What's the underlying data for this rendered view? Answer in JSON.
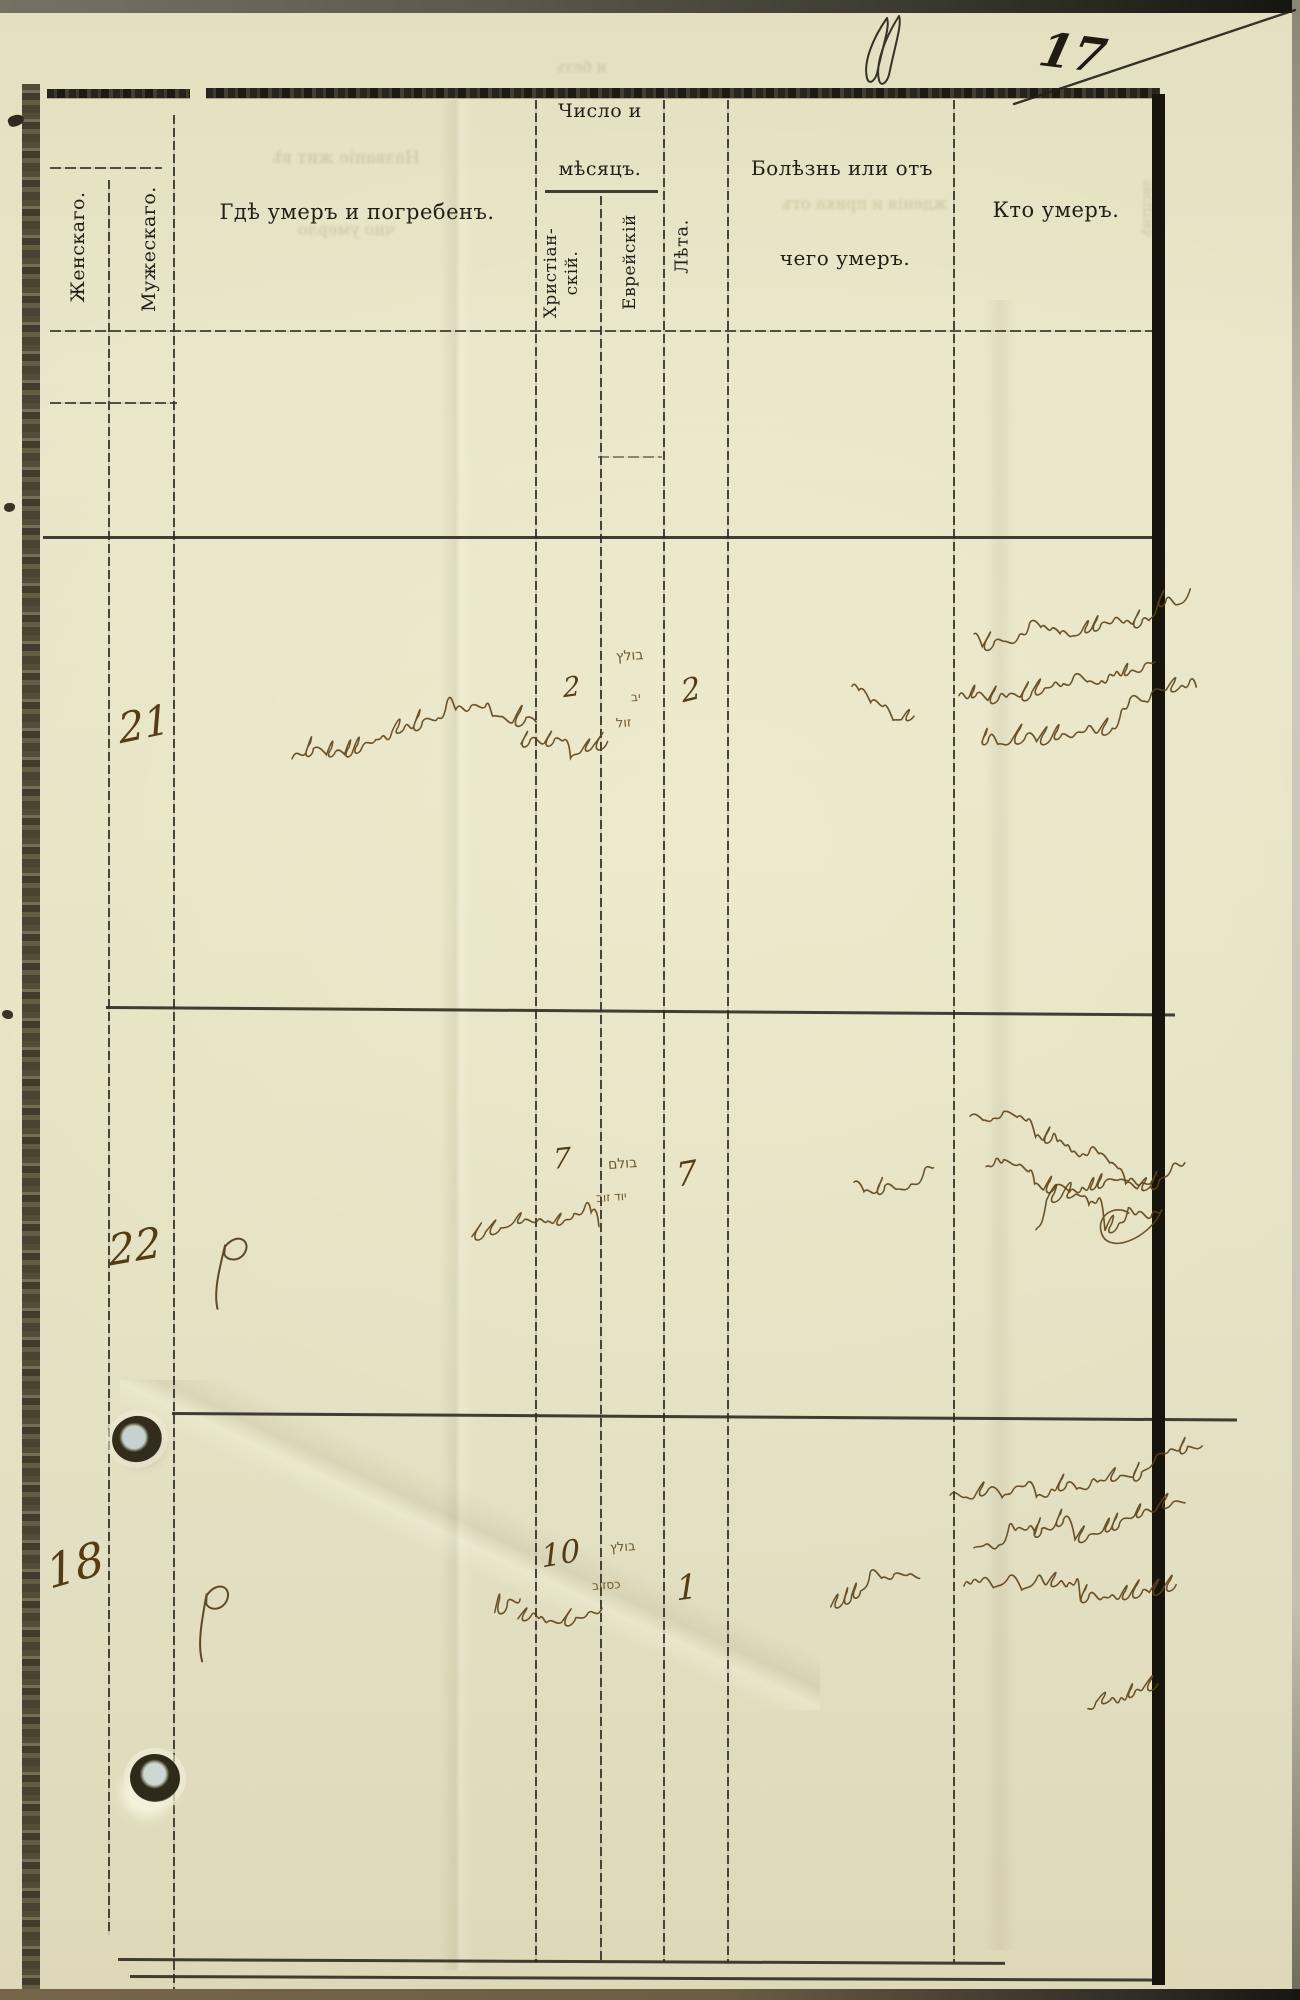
{
  "page": {
    "number": "17",
    "number_mark": "№-flourish"
  },
  "header": {
    "col_female": "Женскаго.",
    "col_male": "Мужескаго.",
    "col_place": "Гдѣ умеръ и погребенъ.",
    "date_group_line1": "Число и",
    "date_group_line2": "мѣсяцъ.",
    "date_christian": "Христіан-\nскій.",
    "date_jewish": "Еврейскій",
    "col_age": "Лѣта.",
    "cause_line1": "Болѣзнь или отъ",
    "cause_line2": "чего умеръ.",
    "col_who": "Кто умеръ."
  },
  "records": [
    {
      "number": "21",
      "sex_column": "male",
      "christian_day": "2",
      "hebrew_date": "בולץ יב זול",
      "age": "2",
      "place": "handwritten Yiddish cursive (town name)",
      "cause": "handwritten cursive word",
      "who": "three lines of Yiddish cursive"
    },
    {
      "number": "22",
      "sex_column": "male",
      "christian_day": "7",
      "hebrew_date": "בולם יוד זוב",
      "age": "7",
      "place": "ditto mark P",
      "cause": "handwritten cursive word",
      "who": "two lines of Yiddish cursive and large signature"
    },
    {
      "number": "18",
      "sex_column": "female",
      "christian_day": "10",
      "hebrew_date": "בולץ כסזוב",
      "age": "1",
      "place": "ditto mark P",
      "cause": "handwritten cursive word",
      "who": "three lines of Yiddish cursive and small word below"
    }
  ],
  "ink": [
    {
      "name": "page-number",
      "type": "text",
      "text": "17",
      "x": 1040,
      "y": 26,
      "size": 47,
      "rot": 7,
      "color": "#1f1b13",
      "weight": "bold"
    },
    {
      "name": "number-flourish",
      "type": "flourish",
      "x": 853,
      "y": 14,
      "h": 76
    },
    {
      "name": "pen-diagonal-line",
      "type": "dline",
      "x1": 1014,
      "y1": 104,
      "x2": 1295,
      "y2": 10
    },
    {
      "name": "record1-number",
      "type": "text",
      "text": "21",
      "x": 118,
      "y": 700,
      "size": 41,
      "rot": -12
    },
    {
      "name": "record1-place-script",
      "type": "squiggle",
      "x": 288,
      "y": 752,
      "w": 235,
      "amp": 13,
      "seed": 11,
      "rot": -3
    },
    {
      "name": "record1-christian-day",
      "type": "text",
      "text": "2",
      "x": 563,
      "y": 672,
      "size": 27,
      "rot": -8
    },
    {
      "name": "record1-month-script",
      "type": "squiggle",
      "x": 517,
      "y": 742,
      "w": 82,
      "amp": 8,
      "seed": 12,
      "rot": -2
    },
    {
      "name": "record1-hebrew-date-1",
      "type": "heb",
      "text": "בולץ",
      "x": 616,
      "y": 648,
      "size": 14,
      "rot": -4
    },
    {
      "name": "record1-hebrew-date-2",
      "type": "heb",
      "text": "יב",
      "x": 631,
      "y": 690,
      "size": 12,
      "rot": -4
    },
    {
      "name": "record1-hebrew-date-3",
      "type": "heb",
      "text": "זול",
      "x": 616,
      "y": 716,
      "size": 13,
      "rot": -4
    },
    {
      "name": "record1-age",
      "type": "text",
      "text": "2",
      "x": 681,
      "y": 672,
      "size": 31,
      "rot": -14
    },
    {
      "name": "record1-cause-script",
      "type": "squiggle",
      "x": 848,
      "y": 682,
      "w": 58,
      "amp": 8,
      "seed": 13,
      "rot": -6
    },
    {
      "name": "record1-who-line1",
      "type": "squiggle",
      "x": 970,
      "y": 626,
      "w": 205,
      "amp": 9,
      "seed": 14,
      "rot": -4
    },
    {
      "name": "record1-who-line2",
      "type": "squiggle",
      "x": 955,
      "y": 690,
      "w": 190,
      "amp": 10,
      "seed": 15,
      "rot": -3
    },
    {
      "name": "record1-who-line3",
      "type": "squiggle",
      "x": 978,
      "y": 738,
      "w": 205,
      "amp": 11,
      "seed": 16,
      "rot": -2
    },
    {
      "name": "record2-number",
      "type": "text",
      "text": "22",
      "x": 108,
      "y": 1222,
      "size": 42,
      "rot": -10
    },
    {
      "name": "record2-place-ditto",
      "type": "pmark",
      "x": 212,
      "y": 1236,
      "h": 76,
      "rot": 6
    },
    {
      "name": "record2-christian-day",
      "type": "text",
      "text": "7",
      "x": 553,
      "y": 1142,
      "size": 28,
      "rot": -6
    },
    {
      "name": "record2-month-script",
      "type": "squiggle",
      "x": 468,
      "y": 1234,
      "w": 118,
      "amp": 8,
      "seed": 17,
      "rot": -2
    },
    {
      "name": "record2-hebrew-date-1",
      "type": "heb",
      "text": "בולם",
      "x": 608,
      "y": 1156,
      "size": 14,
      "rot": -4
    },
    {
      "name": "record2-hebrew-date-2",
      "type": "heb",
      "text": "יוד זוב",
      "x": 596,
      "y": 1190,
      "size": 12,
      "rot": -4
    },
    {
      "name": "record2-age",
      "type": "text",
      "text": "7",
      "x": 676,
      "y": 1154,
      "size": 33,
      "rot": -10
    },
    {
      "name": "record2-cause-script",
      "type": "squiggle",
      "x": 850,
      "y": 1178,
      "w": 72,
      "amp": 8,
      "seed": 18,
      "rot": -5
    },
    {
      "name": "record2-who-line1",
      "type": "squiggle",
      "x": 966,
      "y": 1110,
      "w": 215,
      "amp": 9,
      "seed": 19,
      "rot": -3
    },
    {
      "name": "record2-who-line2",
      "type": "squiggle",
      "x": 982,
      "y": 1160,
      "w": 165,
      "amp": 10,
      "seed": 20,
      "rot": -4
    },
    {
      "name": "record2-who-signature",
      "type": "squiggle",
      "x": 1032,
      "y": 1226,
      "w": 118,
      "amp": 15,
      "seed": 21,
      "rot": -3,
      "tail": true
    },
    {
      "name": "record3-number",
      "type": "text",
      "text": "18",
      "x": 46,
      "y": 1538,
      "size": 46,
      "rot": -16
    },
    {
      "name": "record3-place-ditto",
      "type": "pmark",
      "x": 195,
      "y": 1584,
      "h": 80,
      "rot": 3
    },
    {
      "name": "record3-christian-day",
      "type": "text",
      "text": "10",
      "x": 541,
      "y": 1536,
      "size": 31,
      "rot": -10
    },
    {
      "name": "record3-day-marks",
      "type": "squiggle",
      "x": 490,
      "y": 1604,
      "w": 26,
      "amp": 12,
      "seed": 22,
      "rot": -20
    },
    {
      "name": "record3-month-script",
      "type": "squiggle",
      "x": 514,
      "y": 1616,
      "w": 80,
      "amp": 8,
      "seed": 23,
      "rot": -3
    },
    {
      "name": "record3-hebrew-date-1",
      "type": "heb",
      "text": "בולץ",
      "x": 610,
      "y": 1540,
      "size": 13,
      "rot": -4
    },
    {
      "name": "record3-hebrew-date-2",
      "type": "heb",
      "text": "כסזוב",
      "x": 592,
      "y": 1578,
      "size": 12,
      "rot": -4
    },
    {
      "name": "record3-age",
      "type": "text",
      "text": "1",
      "x": 676,
      "y": 1568,
      "size": 34,
      "rot": -8
    },
    {
      "name": "record3-cause-script",
      "type": "squiggle",
      "x": 826,
      "y": 1596,
      "w": 82,
      "amp": 9,
      "seed": 24,
      "rot": -12
    },
    {
      "name": "record3-who-line1",
      "type": "squiggle",
      "x": 946,
      "y": 1486,
      "w": 238,
      "amp": 9,
      "seed": 25,
      "rot": -4
    },
    {
      "name": "record3-who-line2",
      "type": "squiggle",
      "x": 970,
      "y": 1542,
      "w": 198,
      "amp": 10,
      "seed": 26,
      "rot": -3
    },
    {
      "name": "record3-who-line3",
      "type": "squiggle",
      "x": 960,
      "y": 1582,
      "w": 208,
      "amp": 10,
      "seed": 27,
      "rot": -2
    },
    {
      "name": "record3-extra-word",
      "type": "squiggle",
      "x": 1084,
      "y": 1706,
      "w": 56,
      "amp": 9,
      "seed": 28,
      "rot": -4
    }
  ],
  "ghosts": [
    {
      "name": "bleedthrough-place-1",
      "text": "Названіе жит вѣ",
      "x": 272,
      "y": 148,
      "size": 17
    },
    {
      "name": "bleedthrough-place-2",
      "text": "чно умерло",
      "x": 298,
      "y": 220,
      "size": 16
    },
    {
      "name": "bleedthrough-cause",
      "text": "жденія и прика отъ",
      "x": 782,
      "y": 194,
      "size": 16
    },
    {
      "name": "bleedthrough-date",
      "text": "и безъ",
      "x": 556,
      "y": 58,
      "size": 15
    },
    {
      "name": "bleedthrough-edge",
      "text": "звсцтнѣ",
      "x": 1118,
      "y": 200,
      "size": 14,
      "vert": true
    }
  ]
}
